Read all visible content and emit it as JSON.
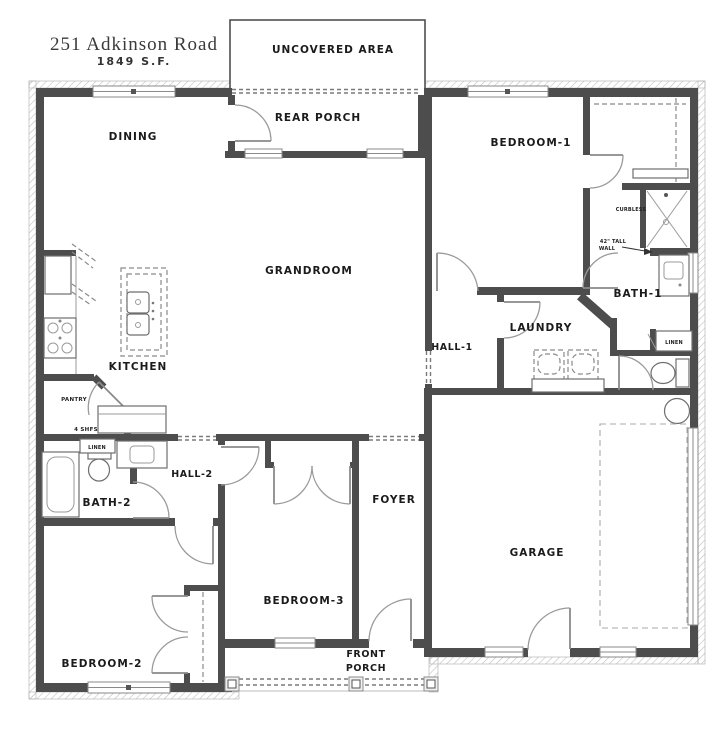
{
  "title": {
    "address": "251 Adkinson Road",
    "area": "1849 S.F."
  },
  "rooms": {
    "uncovered_area": {
      "label": "UNCOVERED AREA"
    },
    "rear_porch": {
      "label": "REAR PORCH"
    },
    "dining": {
      "label": "DINING"
    },
    "bedroom1": {
      "label": "BEDROOM-1"
    },
    "grandroom": {
      "label": "GRANDROOM"
    },
    "kitchen": {
      "label": "KITCHEN"
    },
    "bath1": {
      "label": "BATH-1"
    },
    "hall1": {
      "label": "HALL-1"
    },
    "laundry": {
      "label": "LAUNDRY"
    },
    "pantry": {
      "label": "PANTRY"
    },
    "hall2": {
      "label": "HALL-2"
    },
    "bath2": {
      "label": "BATH-2"
    },
    "foyer": {
      "label": "FOYER"
    },
    "garage": {
      "label": "GARAGE"
    },
    "bedroom2": {
      "label": "BEDROOM-2"
    },
    "bedroom3": {
      "label": "BEDROOM-3"
    },
    "front_porch": {
      "line1": "FRONT",
      "line2": "PORCH"
    }
  },
  "annotations": {
    "curbless": "CURBLESS",
    "tall_wall_line1": "42\" TALL",
    "tall_wall_line2": "WALL",
    "pantry_shelves": "4 SHFS",
    "linen_bath1": "LINEN",
    "linen_hall2": "LINEN"
  },
  "colors": {
    "wall": "#4d4d4d",
    "door_arc": "#9a9a9a",
    "hatch": "#bfbfbf",
    "text": "#1b1b1b",
    "background": "#ffffff"
  }
}
